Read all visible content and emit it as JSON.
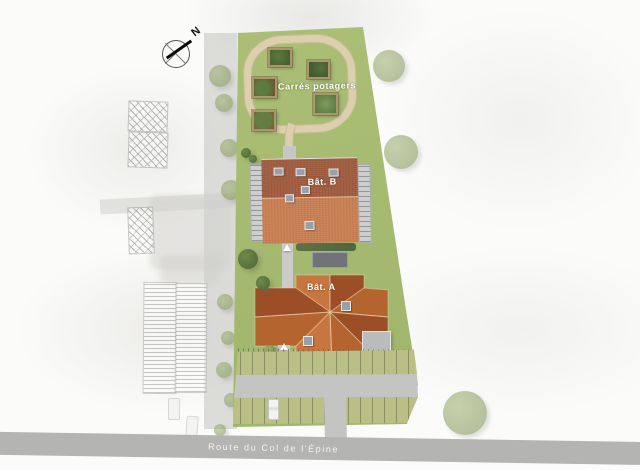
{
  "plan": {
    "compass_label": "N",
    "garden": {
      "label": "Carrés potagers",
      "plot_count": 5
    },
    "buildings": [
      {
        "id": "bat-b",
        "label": "Bât. B"
      },
      {
        "id": "bat-a",
        "label": "Bât. A"
      }
    ],
    "road": {
      "label": "Route du Col de l'Épine"
    },
    "parking": {
      "car_count": 1
    }
  },
  "colors": {
    "site_green": "#adc077",
    "site_green_dark": "#9db369",
    "path_beige": "#d9cdac",
    "roof_b_dark": "#a05a3c",
    "roof_b_light": "#c97e50",
    "roof_a_base": "#b4652f",
    "roof_a_dark": "#9c4e27",
    "roof_a_light": "#c7763f",
    "road_gray": "#b4b4b2",
    "driveway_gray": "#c4c4c2",
    "parking_green": "#b9bf85",
    "balcony_gray": "#cdced0",
    "label_white": "#ffffff"
  }
}
